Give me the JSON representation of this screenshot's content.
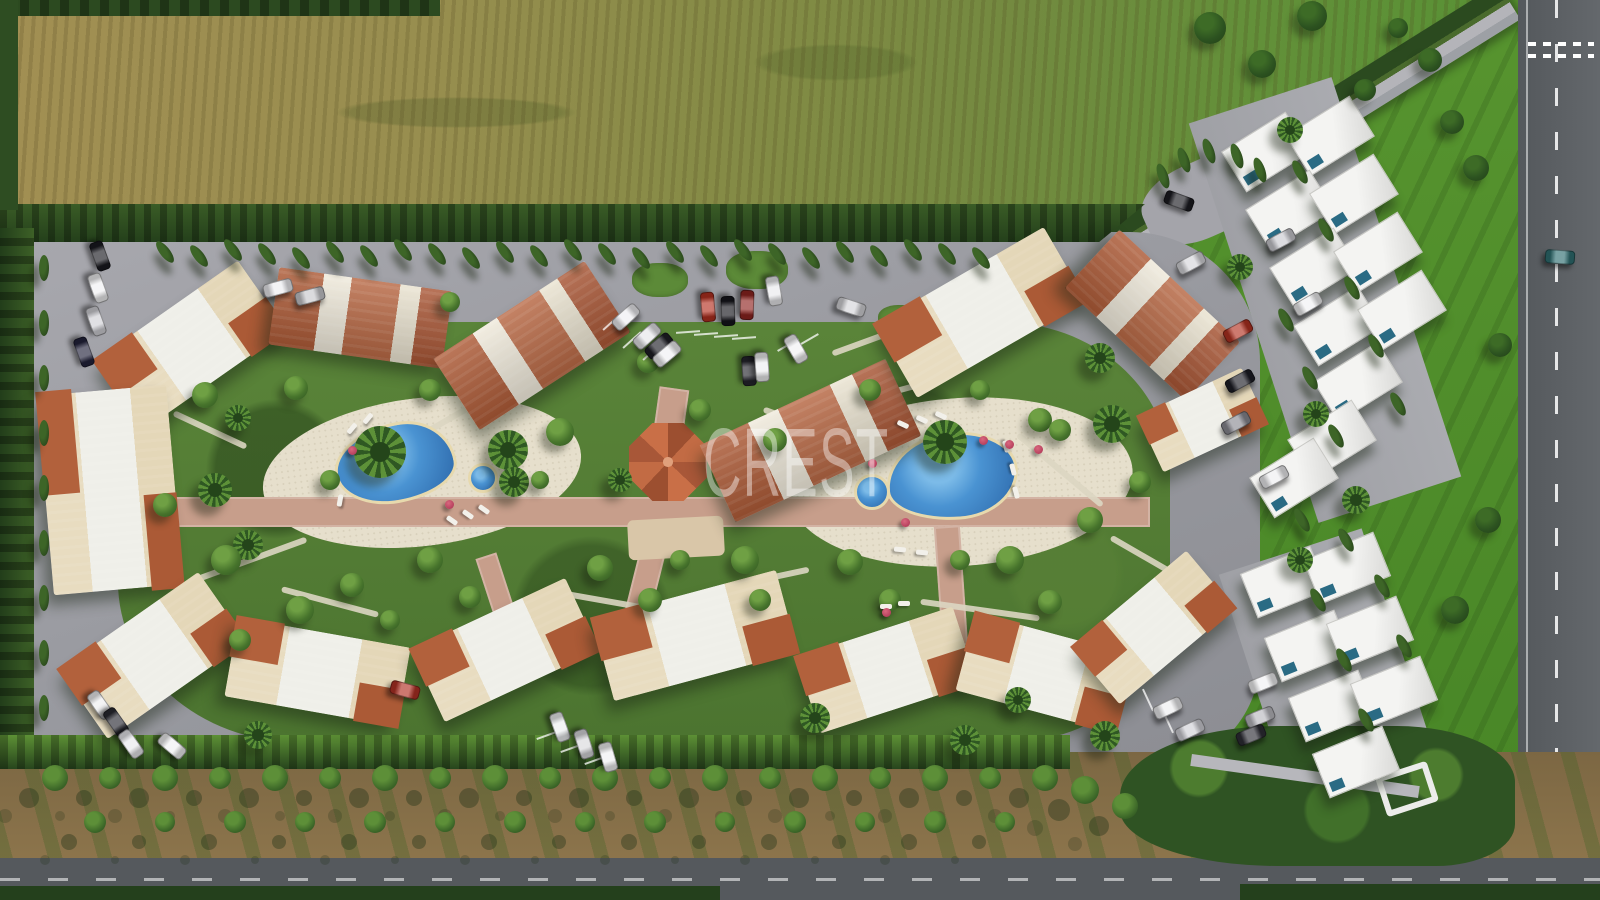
{
  "meta": {
    "description": "Aerial 3D architectural render of a Mediterranean residential resort complex with terracotta-roofed apartment blocks around two swimming pools, white modern villas on the right, fields above and an orchard and roads below"
  },
  "watermark": {
    "text": "CREST",
    "color": "#ffffff",
    "opacity": 0.42
  },
  "palette": {
    "field_dry": "#9c8c50",
    "field_green": "#5f8d36",
    "lawn": "#559330",
    "outer_road": "#5c6064",
    "slab": "#9b9ba1",
    "garden": "#567f37",
    "hedge": "#2c4a20",
    "pool_deep": "#2b66a8",
    "pool_light": "#7cbbe8",
    "deck": "#e6dfcc",
    "path_pink": "#c79e8b",
    "terracotta": "#b2613c",
    "cream_wall": "#e7dabd",
    "villa_white": "#f0f0ee",
    "dirt": "#8a7148"
  },
  "scene": {
    "buildings": [
      {
        "x": 190,
        "y": 345,
        "w": 175,
        "h": 85,
        "r": -35,
        "s": "c"
      },
      {
        "x": 360,
        "y": 318,
        "w": 175,
        "h": 78,
        "r": 8,
        "s": "t"
      },
      {
        "x": 532,
        "y": 345,
        "w": 180,
        "h": 85,
        "r": -33,
        "s": "t"
      },
      {
        "x": 810,
        "y": 440,
        "w": 205,
        "h": 85,
        "r": -25,
        "s": "t"
      },
      {
        "x": 980,
        "y": 312,
        "w": 195,
        "h": 85,
        "r": -30,
        "s": "c"
      },
      {
        "x": 1152,
        "y": 315,
        "w": 165,
        "h": 80,
        "r": 43,
        "s": "t"
      },
      {
        "x": 1202,
        "y": 420,
        "w": 115,
        "h": 62,
        "r": -25,
        "s": "c"
      },
      {
        "x": 110,
        "y": 490,
        "w": 130,
        "h": 200,
        "r": -5,
        "s": "c"
      },
      {
        "x": 153,
        "y": 655,
        "w": 170,
        "h": 85,
        "r": -35,
        "s": "c"
      },
      {
        "x": 317,
        "y": 672,
        "w": 175,
        "h": 80,
        "r": 10,
        "s": "c"
      },
      {
        "x": 505,
        "y": 650,
        "w": 170,
        "h": 80,
        "r": -25,
        "s": "c"
      },
      {
        "x": 695,
        "y": 635,
        "w": 190,
        "h": 85,
        "r": -15,
        "s": "c"
      },
      {
        "x": 886,
        "y": 670,
        "w": 165,
        "h": 80,
        "r": -18,
        "s": "c"
      },
      {
        "x": 1045,
        "y": 673,
        "w": 165,
        "h": 80,
        "r": 15,
        "s": "c"
      },
      {
        "x": 1153,
        "y": 627,
        "w": 150,
        "h": 75,
        "r": -40,
        "s": "c"
      }
    ],
    "villas": [
      [
        1266,
        152,
        -32
      ],
      [
        1330,
        136,
        -32
      ],
      [
        1290,
        210,
        -32
      ],
      [
        1354,
        194,
        -32
      ],
      [
        1314,
        268,
        -32
      ],
      [
        1378,
        252,
        -32
      ],
      [
        1338,
        326,
        -32
      ],
      [
        1402,
        310,
        -32
      ],
      [
        1358,
        382,
        -32
      ],
      [
        1332,
        440,
        -32
      ],
      [
        1294,
        478,
        -32
      ],
      [
        1284,
        582,
        -22
      ],
      [
        1347,
        568,
        -22
      ],
      [
        1308,
        646,
        -22
      ],
      [
        1370,
        632,
        -22
      ],
      [
        1332,
        706,
        -22
      ],
      [
        1394,
        692,
        -22
      ],
      [
        1356,
        762,
        -22
      ]
    ],
    "cypresses": [
      [
        165,
        252,
        -38
      ],
      [
        199,
        256,
        -38
      ],
      [
        233,
        250,
        -38
      ],
      [
        267,
        254,
        -38
      ],
      [
        301,
        258,
        -38
      ],
      [
        335,
        252,
        -38
      ],
      [
        369,
        256,
        -38
      ],
      [
        403,
        250,
        -38
      ],
      [
        437,
        254,
        -38
      ],
      [
        471,
        258,
        -38
      ],
      [
        505,
        252,
        -38
      ],
      [
        539,
        256,
        -38
      ],
      [
        573,
        250,
        -38
      ],
      [
        607,
        254,
        -38
      ],
      [
        641,
        258,
        -38
      ],
      [
        675,
        252,
        -38
      ],
      [
        709,
        256,
        -38
      ],
      [
        743,
        250,
        -38
      ],
      [
        777,
        254,
        -38
      ],
      [
        811,
        258,
        -38
      ],
      [
        845,
        252,
        -38
      ],
      [
        879,
        256,
        -38
      ],
      [
        913,
        250,
        -38
      ],
      [
        947,
        254,
        -38
      ],
      [
        981,
        258,
        -38
      ],
      [
        44,
        268,
        0
      ],
      [
        44,
        323,
        0
      ],
      [
        44,
        378,
        0
      ],
      [
        44,
        433,
        0
      ],
      [
        44,
        488,
        0
      ],
      [
        44,
        543,
        0
      ],
      [
        44,
        598,
        0
      ],
      [
        44,
        653,
        0
      ],
      [
        44,
        708,
        0
      ],
      [
        1300,
        172,
        -30
      ],
      [
        1326,
        230,
        -30
      ],
      [
        1352,
        288,
        -30
      ],
      [
        1376,
        346,
        -30
      ],
      [
        1398,
        404,
        -30
      ],
      [
        1286,
        320,
        -30
      ],
      [
        1310,
        378,
        -30
      ],
      [
        1336,
        436,
        -30
      ],
      [
        1302,
        520,
        -30
      ],
      [
        1346,
        540,
        -30
      ],
      [
        1318,
        600,
        -30
      ],
      [
        1382,
        586,
        -30
      ],
      [
        1344,
        660,
        -30
      ],
      [
        1404,
        646,
        -30
      ],
      [
        1366,
        720,
        -30
      ],
      [
        1163,
        176,
        -20
      ],
      [
        1184,
        160,
        -20
      ],
      [
        1209,
        151,
        -20
      ],
      [
        1237,
        156,
        -20
      ],
      [
        1260,
        170,
        -20
      ]
    ],
    "palms": [
      [
        380,
        452,
        26
      ],
      [
        508,
        450,
        20
      ],
      [
        514,
        482,
        15
      ],
      [
        945,
        442,
        22
      ],
      [
        1112,
        424,
        19
      ],
      [
        1100,
        358,
        15
      ],
      [
        215,
        490,
        17
      ],
      [
        248,
        545,
        15
      ],
      [
        238,
        418,
        13
      ],
      [
        815,
        718,
        15
      ],
      [
        965,
        740,
        15
      ],
      [
        1105,
        736,
        15
      ],
      [
        1290,
        130,
        13
      ],
      [
        1240,
        267,
        13
      ],
      [
        1316,
        414,
        13
      ],
      [
        1356,
        500,
        14
      ],
      [
        1300,
        560,
        13
      ],
      [
        1018,
        700,
        13
      ],
      [
        258,
        735,
        14
      ],
      [
        620,
        480,
        12
      ]
    ],
    "bushes": [
      [
        205,
        395,
        13
      ],
      [
        296,
        388,
        12
      ],
      [
        226,
        560,
        15
      ],
      [
        300,
        610,
        14
      ],
      [
        352,
        585,
        12
      ],
      [
        165,
        505,
        12
      ],
      [
        430,
        560,
        13
      ],
      [
        470,
        597,
        11
      ],
      [
        560,
        432,
        14
      ],
      [
        600,
        568,
        13
      ],
      [
        650,
        600,
        12
      ],
      [
        745,
        560,
        14
      ],
      [
        775,
        440,
        12
      ],
      [
        700,
        410,
        11
      ],
      [
        850,
        562,
        13
      ],
      [
        890,
        600,
        11
      ],
      [
        1010,
        560,
        14
      ],
      [
        1050,
        602,
        12
      ],
      [
        1090,
        520,
        13
      ],
      [
        1140,
        482,
        11
      ],
      [
        1040,
        420,
        12
      ],
      [
        870,
        390,
        11
      ],
      [
        430,
        390,
        11
      ],
      [
        330,
        480,
        10
      ],
      [
        540,
        480,
        9
      ],
      [
        960,
        560,
        10
      ],
      [
        760,
        600,
        11
      ],
      [
        680,
        560,
        10
      ],
      [
        648,
        362,
        11
      ],
      [
        450,
        302,
        10
      ],
      [
        980,
        390,
        10
      ],
      [
        1060,
        430,
        11
      ],
      [
        240,
        640,
        11
      ],
      [
        390,
        620,
        10
      ]
    ],
    "lawn_bushes": [
      [
        1210,
        28,
        16
      ],
      [
        1262,
        64,
        14
      ],
      [
        1312,
        16,
        15
      ],
      [
        1476,
        168,
        13
      ],
      [
        1452,
        122,
        12
      ],
      [
        1500,
        345,
        12
      ],
      [
        1488,
        520,
        13
      ],
      [
        1455,
        610,
        14
      ],
      [
        1430,
        60,
        12
      ],
      [
        1398,
        28,
        10
      ],
      [
        1365,
        90,
        11
      ]
    ],
    "orchard_trees": [
      [
        55,
        778,
        13
      ],
      [
        110,
        778,
        11
      ],
      [
        165,
        778,
        13
      ],
      [
        220,
        778,
        11
      ],
      [
        275,
        778,
        13
      ],
      [
        330,
        778,
        11
      ],
      [
        385,
        778,
        13
      ],
      [
        440,
        778,
        11
      ],
      [
        495,
        778,
        13
      ],
      [
        550,
        778,
        11
      ],
      [
        605,
        778,
        13
      ],
      [
        660,
        778,
        11
      ],
      [
        715,
        778,
        13
      ],
      [
        770,
        778,
        11
      ],
      [
        825,
        778,
        13
      ],
      [
        880,
        778,
        11
      ],
      [
        935,
        778,
        13
      ],
      [
        990,
        778,
        11
      ],
      [
        1045,
        778,
        13
      ],
      [
        95,
        822,
        11
      ],
      [
        165,
        822,
        10
      ],
      [
        235,
        822,
        11
      ],
      [
        305,
        822,
        10
      ],
      [
        375,
        822,
        11
      ],
      [
        445,
        822,
        10
      ],
      [
        515,
        822,
        11
      ],
      [
        585,
        822,
        10
      ],
      [
        655,
        822,
        11
      ],
      [
        725,
        822,
        10
      ],
      [
        795,
        822,
        11
      ],
      [
        865,
        822,
        10
      ],
      [
        935,
        822,
        11
      ],
      [
        1005,
        822,
        10
      ],
      [
        1085,
        790,
        14
      ],
      [
        1125,
        806,
        13
      ]
    ],
    "cars": [
      [
        708,
        307,
        85,
        "#b33020"
      ],
      [
        728,
        311,
        88,
        "#16161c"
      ],
      [
        747,
        305,
        92,
        "#8f2420"
      ],
      [
        774,
        291,
        80,
        "#e9e9ec"
      ],
      [
        851,
        307,
        18,
        "#d4d4d8"
      ],
      [
        626,
        317,
        -42,
        "#eeeef2"
      ],
      [
        647,
        336,
        -42,
        "#e6e6ea"
      ],
      [
        659,
        346,
        -40,
        "#1f1f26"
      ],
      [
        667,
        354,
        -40,
        "#f0f0f2"
      ],
      [
        749,
        371,
        86,
        "#26262e"
      ],
      [
        762,
        367,
        86,
        "#ededef"
      ],
      [
        796,
        349,
        60,
        "#f1f1f3"
      ],
      [
        278,
        288,
        -15,
        "#ececf0"
      ],
      [
        310,
        296,
        -15,
        "#c8c8cc"
      ],
      [
        100,
        256,
        70,
        "#1a1a20"
      ],
      [
        98,
        288,
        70,
        "#f0f0f2"
      ],
      [
        96,
        321,
        70,
        "#d0d0d6"
      ],
      [
        84,
        352,
        70,
        "#23233c"
      ],
      [
        100,
        705,
        55,
        "#eeeef0"
      ],
      [
        116,
        722,
        55,
        "#2a2a32"
      ],
      [
        131,
        744,
        55,
        "#e8e8ec"
      ],
      [
        172,
        746,
        40,
        "#f0f0f2"
      ],
      [
        560,
        727,
        70,
        "#eceef0"
      ],
      [
        584,
        744,
        72,
        "#d8d8dc"
      ],
      [
        608,
        757,
        74,
        "#f0f0f2"
      ],
      [
        405,
        690,
        15,
        "#b03024"
      ],
      [
        1168,
        708,
        -25,
        "#eeeef0"
      ],
      [
        1190,
        730,
        -25,
        "#cfcfd5"
      ],
      [
        1179,
        201,
        20,
        "#1c1c22"
      ],
      [
        1191,
        263,
        -28,
        "#d6d6da"
      ],
      [
        1281,
        240,
        -28,
        "#c9c9cf"
      ],
      [
        1308,
        304,
        -30,
        "#f0f0f2"
      ],
      [
        1238,
        331,
        -28,
        "#b23222"
      ],
      [
        1240,
        381,
        -28,
        "#1e1e26"
      ],
      [
        1236,
        423,
        -28,
        "#8a8a92"
      ],
      [
        1274,
        477,
        -28,
        "#eeeef0"
      ],
      [
        1263,
        683,
        -22,
        "#f0f0f2"
      ],
      [
        1260,
        717,
        -22,
        "#b9b9bf"
      ],
      [
        1251,
        735,
        -22,
        "#2e2e36"
      ],
      [
        1560,
        257,
        4,
        "#2f6f72"
      ]
    ],
    "loungers": [
      [
        352,
        428,
        -50
      ],
      [
        368,
        418,
        -50
      ],
      [
        452,
        520,
        35
      ],
      [
        468,
        514,
        35
      ],
      [
        484,
        509,
        35
      ],
      [
        340,
        500,
        -80
      ],
      [
        903,
        424,
        25
      ],
      [
        922,
        419,
        25
      ],
      [
        941,
        415,
        25
      ],
      [
        1006,
        446,
        75
      ],
      [
        1013,
        469,
        75
      ],
      [
        1016,
        492,
        75
      ],
      [
        900,
        549,
        5
      ],
      [
        922,
        552,
        5
      ],
      [
        886,
        606,
        0
      ],
      [
        904,
        603,
        0
      ]
    ],
    "umbrellas": [
      [
        983,
        440
      ],
      [
        1009,
        444
      ],
      [
        1038,
        449
      ],
      [
        872,
        463
      ],
      [
        905,
        522
      ],
      [
        352,
        450
      ],
      [
        449,
        504
      ],
      [
        886,
        612
      ]
    ],
    "stall_lines": [
      [
        612,
        322,
        48
      ],
      [
        632,
        340,
        48
      ],
      [
        652,
        352,
        48
      ],
      [
        688,
        332,
        86
      ],
      [
        706,
        334,
        86
      ],
      [
        726,
        336,
        86
      ],
      [
        744,
        338,
        86
      ],
      [
        788,
        345,
        60
      ],
      [
        808,
        340,
        60
      ],
      [
        548,
        735,
        70
      ],
      [
        572,
        748,
        70
      ],
      [
        596,
        760,
        70
      ],
      [
        1148,
        700,
        -25
      ],
      [
        1168,
        722,
        -25
      ]
    ],
    "islands": [
      [
        660,
        280,
        56,
        34
      ],
      [
        757,
        270,
        62,
        38
      ],
      [
        900,
        318,
        44,
        26
      ]
    ],
    "path_strips": [
      [
        250,
        560,
        120,
        -20
      ],
      [
        330,
        602,
        100,
        15
      ],
      [
        820,
        430,
        120,
        20
      ],
      [
        900,
        390,
        90,
        -15
      ],
      [
        1060,
        470,
        110,
        40
      ],
      [
        430,
        430,
        90,
        -30
      ],
      [
        600,
        600,
        110,
        10
      ],
      [
        760,
        580,
        100,
        -12
      ],
      [
        980,
        610,
        120,
        8
      ],
      [
        210,
        430,
        80,
        25
      ],
      [
        1150,
        560,
        90,
        30
      ],
      [
        870,
        340,
        80,
        -20
      ]
    ],
    "pink_paths": [
      [
        135,
        497,
        1015,
        30,
        0
      ],
      [
        655,
        388,
        30,
        64,
        8
      ],
      [
        938,
        526,
        26,
        120,
        -4
      ],
      [
        634,
        526,
        26,
        98,
        14
      ],
      [
        486,
        554,
        22,
        72,
        -18
      ]
    ]
  }
}
